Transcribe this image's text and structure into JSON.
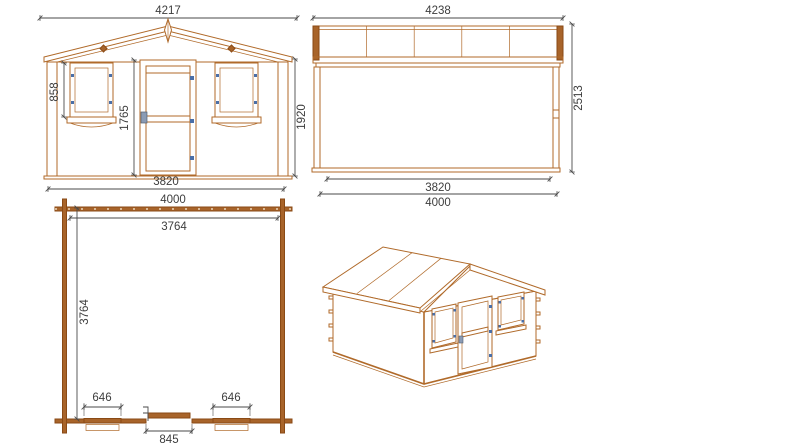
{
  "drawing_title": "log-cabin-shed-technical-drawing",
  "colors": {
    "wood_line": "#b06a2a",
    "wood_dark": "#8a4a15",
    "hinge_blue": "#4a6fa8",
    "dimension": "#4a4a4a",
    "background": "#ffffff"
  },
  "views": {
    "front_elevation": {
      "label": "front elevation",
      "dims": {
        "roof_width": "4217",
        "window_height": "858",
        "door_height": "1765",
        "wall_height": "1920",
        "wall_width": "3820"
      }
    },
    "side_elevation": {
      "label": "side elevation",
      "dims": {
        "roof_length": "4238",
        "total_height": "2513",
        "wall_length": "3820",
        "base_length": "4000"
      }
    },
    "floor_plan": {
      "label": "floor plan",
      "dims": {
        "outer_width": "4000",
        "inner_width": "3764",
        "inner_depth": "3764",
        "left_window_width": "646",
        "right_window_width": "646",
        "door_width": "845"
      }
    },
    "iso_view": {
      "label": "3d perspective view"
    }
  }
}
